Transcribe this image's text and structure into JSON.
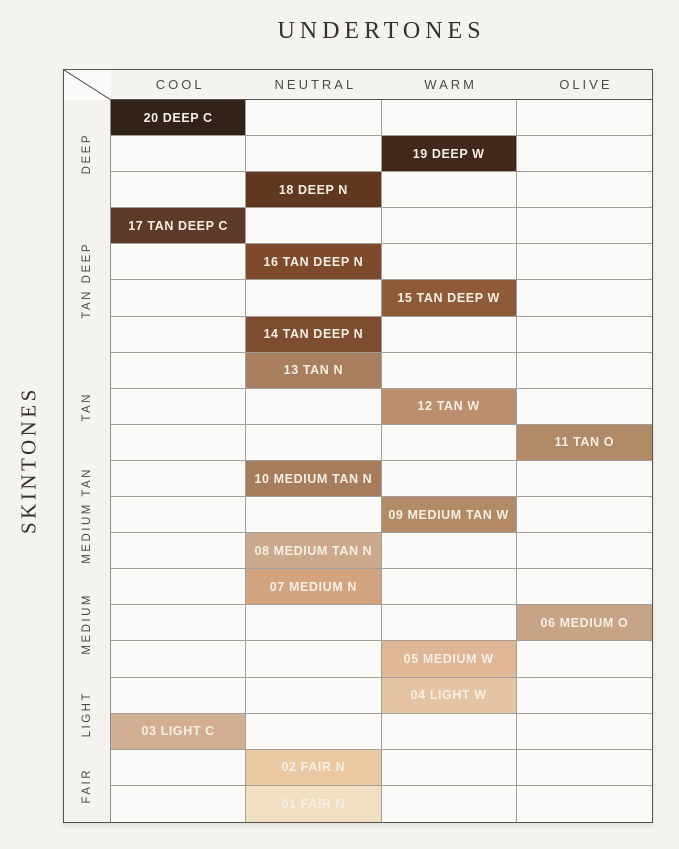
{
  "page": {
    "title": "UNDERTONES",
    "side_title": "SKINTONES",
    "background": "#f4f3f0"
  },
  "chart_data": {
    "type": "table",
    "title": "UNDERTONES",
    "row_axis_label": "SKINTONES",
    "columns": [
      "COOL",
      "NEUTRAL",
      "WARM",
      "OLIVE"
    ],
    "row_groups": [
      {
        "label": "DEEP",
        "rows": 3
      },
      {
        "label": "TAN DEEP",
        "rows": 4
      },
      {
        "label": "TAN",
        "rows": 3
      },
      {
        "label": "MEDIUM TAN",
        "rows": 3
      },
      {
        "label": "MEDIUM",
        "rows": 3
      },
      {
        "label": "LIGHT",
        "rows": 2
      },
      {
        "label": "FAIR",
        "rows": 2
      }
    ],
    "num_rows": 20,
    "shades": [
      {
        "row": 1,
        "column": "COOL",
        "label": "20 DEEP C",
        "color": "#332218"
      },
      {
        "row": 2,
        "column": "WARM",
        "label": "19 DEEP W",
        "color": "#41281a"
      },
      {
        "row": 3,
        "column": "NEUTRAL",
        "label": "18 DEEP N",
        "color": "#60371f"
      },
      {
        "row": 4,
        "column": "COOL",
        "label": "17 TAN DEEP C",
        "color": "#5e3b29"
      },
      {
        "row": 5,
        "column": "NEUTRAL",
        "label": "16 TAN DEEP N",
        "color": "#7d4a2c"
      },
      {
        "row": 6,
        "column": "WARM",
        "label": "15 TAN DEEP W",
        "color": "#8f5a38"
      },
      {
        "row": 7,
        "column": "NEUTRAL",
        "label": "14 TAN DEEP N",
        "color": "#7e4c2f"
      },
      {
        "row": 8,
        "column": "NEUTRAL",
        "label": "13 TAN N",
        "color": "#a87e5e"
      },
      {
        "row": 9,
        "column": "WARM",
        "label": "12 TAN W",
        "color": "#bb8f6e"
      },
      {
        "row": 10,
        "column": "OLIVE",
        "label": "11 TAN O",
        "color": "#b08a67"
      },
      {
        "row": 11,
        "column": "NEUTRAL",
        "label": "10 MEDIUM TAN N",
        "color": "#a67c5b"
      },
      {
        "row": 12,
        "column": "WARM",
        "label": "09 MEDIUM TAN W",
        "color": "#b38a66"
      },
      {
        "row": 13,
        "column": "NEUTRAL",
        "label": "08 MEDIUM TAN N",
        "color": "#cca88c"
      },
      {
        "row": 14,
        "column": "NEUTRAL",
        "label": "07 MEDIUM N",
        "color": "#d2a37f"
      },
      {
        "row": 15,
        "column": "OLIVE",
        "label": "06 MEDIUM O",
        "color": "#c7a485"
      },
      {
        "row": 16,
        "column": "WARM",
        "label": "05 MEDIUM W",
        "color": "#dfb796"
      },
      {
        "row": 17,
        "column": "WARM",
        "label": "04 LIGHT W",
        "color": "#e5c4a4"
      },
      {
        "row": 18,
        "column": "COOL",
        "label": "03 LIGHT C",
        "color": "#d2ae92"
      },
      {
        "row": 19,
        "column": "NEUTRAL",
        "label": "02 FAIR N",
        "color": "#e9c8a2"
      },
      {
        "row": 20,
        "column": "NEUTRAL",
        "label": "01 FAIR N",
        "color": "#f0dfc2"
      }
    ],
    "colors": {
      "swatch_label_text": "#f6efe3",
      "grid_line": "#a3a09c",
      "outer_border": "#55534f",
      "empty_cell": "#fbfaf9",
      "header_text": "#4c4a46",
      "title_text": "#34312b",
      "page_background": "#f4f3f0"
    }
  }
}
